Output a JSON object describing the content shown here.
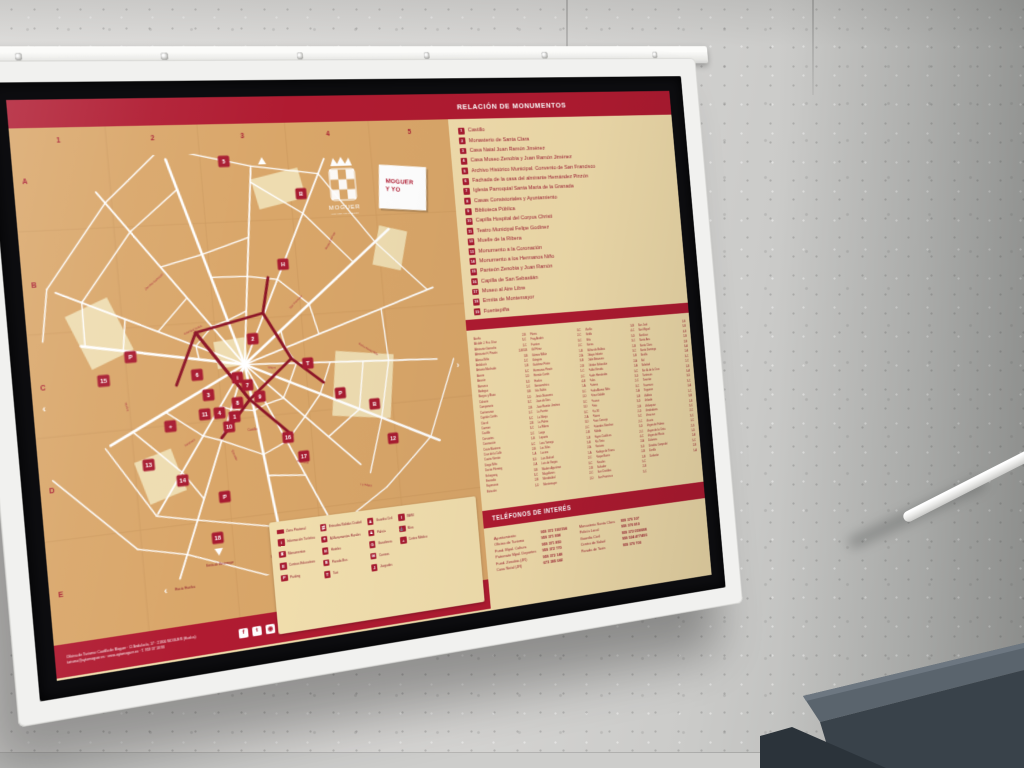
{
  "board": {
    "header": {
      "monuments_title": "RELACIÓN DE MONUMENTOS"
    },
    "logo": {
      "city": "MOGUER",
      "tagline": "LUGARES COLOMBINOS"
    },
    "brand_card": {
      "line1": "MOGUER",
      "line2": "Y YO"
    },
    "colors": {
      "band_red": "#b01b31",
      "marker_red": "#a81c31",
      "map_tan": "#d9a669",
      "panel_cream": "#f0dcab",
      "street_white": "#ffffff",
      "pedestrian_red": "#8c1527"
    },
    "map": {
      "grid_cols": [
        "1",
        "2",
        "3",
        "4",
        "5"
      ],
      "grid_rows": [
        "A",
        "B",
        "C",
        "D",
        "E"
      ],
      "exit_left": "Hacia Huelva",
      "exit_right": "Hacia Mazagón",
      "down_label_1": "Ermita de Montemayor",
      "down_label_2": "Fuentepiña",
      "markers": [
        {
          "t": "5",
          "x": 193,
          "y": 36
        },
        {
          "t": "2",
          "x": 206,
          "y": 208
        },
        {
          "t": "15",
          "x": 64,
          "y": 236
        },
        {
          "t": "6",
          "x": 150,
          "y": 238
        },
        {
          "t": "7",
          "x": 197,
          "y": 252
        },
        {
          "t": "3",
          "x": 159,
          "y": 258
        },
        {
          "t": "8",
          "x": 186,
          "y": 268
        },
        {
          "t": "9",
          "x": 208,
          "y": 264
        },
        {
          "t": "1",
          "x": 182,
          "y": 281
        },
        {
          "t": "4",
          "x": 168,
          "y": 276
        },
        {
          "t": "11",
          "x": 154,
          "y": 276
        },
        {
          "t": "10",
          "x": 176,
          "y": 290
        },
        {
          "t": "13",
          "x": 98,
          "y": 318
        },
        {
          "t": "14",
          "x": 128,
          "y": 336
        },
        {
          "t": "16",
          "x": 232,
          "y": 306
        },
        {
          "t": "17",
          "x": 246,
          "y": 326
        },
        {
          "t": "12",
          "x": 338,
          "y": 318
        },
        {
          "t": "18",
          "x": 156,
          "y": 394
        },
        {
          "t": "19",
          "x": 212,
          "y": 394
        },
        {
          "t": "P",
          "x": 90,
          "y": 216
        },
        {
          "t": "P",
          "x": 166,
          "y": 356
        },
        {
          "t": "P",
          "x": 288,
          "y": 268
        },
        {
          "t": "H",
          "x": 242,
          "y": 138
        },
        {
          "t": "B",
          "x": 322,
          "y": 282
        },
        {
          "t": "B",
          "x": 266,
          "y": 70
        },
        {
          "t": "i",
          "x": 188,
          "y": 244
        },
        {
          "t": "+",
          "x": 121,
          "y": 284
        },
        {
          "t": "T",
          "x": 258,
          "y": 236
        }
      ],
      "street_labels": [
        {
          "t": "Cristóbal Colón",
          "x": 150,
          "y": 196,
          "r": -20
        },
        {
          "t": "Zenobia Camprubí",
          "x": 118,
          "y": 148,
          "r": -38
        },
        {
          "t": "San Francisco",
          "x": 252,
          "y": 176,
          "r": -42
        },
        {
          "t": "Nueva",
          "x": 222,
          "y": 238,
          "r": 8
        },
        {
          "t": "Trasmuro",
          "x": 138,
          "y": 302,
          "r": -28
        },
        {
          "t": "Enmedio",
          "x": 178,
          "y": 318,
          "r": 70
        },
        {
          "t": "Andalucía",
          "x": 244,
          "y": 332,
          "r": 18
        },
        {
          "t": "La Ribera",
          "x": 306,
          "y": 362,
          "r": 14
        },
        {
          "t": "Reyes Católicos",
          "x": 292,
          "y": 118,
          "r": -58
        },
        {
          "t": "Huelva",
          "x": 82,
          "y": 262,
          "r": 78
        },
        {
          "t": "Pedro Alonso Niño",
          "x": 320,
          "y": 228,
          "r": 34
        },
        {
          "t": "Castillo",
          "x": 198,
          "y": 296,
          "r": 0
        }
      ]
    },
    "monuments": [
      {
        "num": "1",
        "name": "Castillo"
      },
      {
        "num": "2",
        "name": "Monasterio de Santa Clara"
      },
      {
        "num": "3",
        "name": "Casa Natal Juan Ramón Jiménez"
      },
      {
        "num": "4",
        "name": "Casa Museo Zenobia y Juan Ramón Jiménez"
      },
      {
        "num": "5",
        "name": "Archivo Histórico Municipal. Convento de San Francisco"
      },
      {
        "num": "6",
        "name": "Fachada de la casa del almirante Hernández Pinzón"
      },
      {
        "num": "7",
        "name": "Iglesia Parroquial Santa María de la Granada"
      },
      {
        "num": "8",
        "name": "Casas Consistoriales y Ayuntamiento"
      },
      {
        "num": "9",
        "name": "Biblioteca Pública"
      },
      {
        "num": "10",
        "name": "Capilla Hospital del Corpus Christi"
      },
      {
        "num": "11",
        "name": "Teatro Municipal Felipe Godínez"
      },
      {
        "num": "12",
        "name": "Muelle de la Ribera"
      },
      {
        "num": "13",
        "name": "Monumento a la Coronación"
      },
      {
        "num": "14",
        "name": "Monumento a los Hermanos Niño"
      },
      {
        "num": "15",
        "name": "Panteón Zenobia y Juan Ramón"
      },
      {
        "num": "16",
        "name": "Capilla de San Sebastián"
      },
      {
        "num": "17",
        "name": "Museo al Aire Libre"
      },
      {
        "num": "18",
        "name": "Ermita de Montemayor"
      },
      {
        "num": "19",
        "name": "Fuentepiña"
      }
    ],
    "street_index": {
      "columns": [
        [
          {
            "n": "Aceña",
            "r": "2-B"
          },
          {
            "n": "Alcalde J. Fco. Díaz",
            "r": "3-C"
          },
          {
            "n": "Almirante Garrocho",
            "r": "2-C"
          },
          {
            "n": "Almirante H. Pinzón",
            "r": "2-B/3-B"
          },
          {
            "n": "Alonso Niño",
            "r": "3-B"
          },
          {
            "n": "Andalucía",
            "r": "2-C"
          },
          {
            "n": "Antonio Machado",
            "r": "1-B"
          },
          {
            "n": "Aurora",
            "r": "3-C"
          },
          {
            "n": "Azacán",
            "r": "2-D"
          },
          {
            "n": "Barranco",
            "r": "3-D"
          },
          {
            "n": "Bodegas",
            "r": "2-C"
          },
          {
            "n": "Burgos y Mazo",
            "r": "3-B"
          },
          {
            "n": "Calvario",
            "r": "2-D"
          },
          {
            "n": "Campanario",
            "r": "3-C"
          },
          {
            "n": "Cantarranas",
            "r": "2-B"
          },
          {
            "n": "Capitán Cortés",
            "r": "1-C"
          },
          {
            "n": "Cárcel",
            "r": "3-C"
          },
          {
            "n": "Carmen",
            "r": "2-B"
          },
          {
            "n": "Castillo",
            "r": "3-C"
          },
          {
            "n": "Cervantes",
            "r": "2-C"
          },
          {
            "n": "Coronación",
            "r": "1-B"
          },
          {
            "n": "Cristo Marinero",
            "r": "4-C"
          },
          {
            "n": "Cruz de la Calle",
            "r": "2-B"
          },
          {
            "n": "Cuatro Vientos",
            "r": "1-A"
          },
          {
            "n": "Diego Niño",
            "r": "3-D"
          },
          {
            "n": "Doctor Fleming",
            "r": "2-A"
          },
          {
            "n": "Echegaray",
            "r": "3-B"
          },
          {
            "n": "Enmedio",
            "r": "3-C"
          },
          {
            "n": "Esperanza",
            "r": "2-B"
          },
          {
            "n": "Estación",
            "r": "1-D"
          }
        ],
        [
          {
            "n": "Flores",
            "r": "3-C"
          },
          {
            "n": "Fray Andrés",
            "r": "2-C"
          },
          {
            "n": "Fuentes",
            "r": "3-C"
          },
          {
            "n": "Gil Pérez",
            "r": "2-C"
          },
          {
            "n": "Gómez Millán",
            "r": "1-B"
          },
          {
            "n": "Góngora",
            "r": "2-A"
          },
          {
            "n": "Gutiérrez Prieto",
            "r": "3-B"
          },
          {
            "n": "Hermanos Pinzón",
            "r": "2-B"
          },
          {
            "n": "Hernán Cortés",
            "r": "1-C"
          },
          {
            "n": "Huelva",
            "r": "2-C"
          },
          {
            "n": "Iberoamérica",
            "r": "4-B"
          },
          {
            "n": "Isla Saltés",
            "r": "1-A"
          },
          {
            "n": "Jesús Nazareno",
            "r": "3-C"
          },
          {
            "n": "Juan de Dios",
            "r": "2-D"
          },
          {
            "n": "Juan Ramón Jiménez",
            "r": "3-C"
          },
          {
            "n": "La Fuente",
            "r": "3-D"
          },
          {
            "n": "La Monja",
            "r": "3-C"
          },
          {
            "n": "La Palma",
            "r": "2-A"
          },
          {
            "n": "La Ribera",
            "r": "3-D"
          },
          {
            "n": "Larga",
            "r": "2-C"
          },
          {
            "n": "Lepanto",
            "r": "2-B"
          },
          {
            "n": "Lora Tamayo",
            "r": "1-B"
          },
          {
            "n": "Los Silos",
            "r": "3-B"
          },
          {
            "n": "Lucena",
            "r": "2-A"
          },
          {
            "n": "Luis Buñuel",
            "r": "1-A"
          },
          {
            "n": "Luis de Vargas",
            "r": "2-C"
          },
          {
            "n": "Madres Agustinas",
            "r": "3-C"
          },
          {
            "n": "Magallanes",
            "r": "2-B"
          },
          {
            "n": "Mendizábal",
            "r": "2-C"
          },
          {
            "n": "Montemayor",
            "r": "2-D"
          }
        ],
        [
          {
            "n": "Murillo",
            "r": "3-B"
          },
          {
            "n": "Niebla",
            "r": "4-C"
          },
          {
            "n": "Niña",
            "r": "3-D"
          },
          {
            "n": "Nueva",
            "r": "3-C"
          },
          {
            "n": "Núñez de Balboa",
            "r": "2-B"
          },
          {
            "n": "Obispo Infante",
            "r": "3-C"
          },
          {
            "n": "Odón Betanzos",
            "r": "1-B"
          },
          {
            "n": "Orfebre Sebastián",
            "r": "2-A"
          },
          {
            "n": "Pablo Neruda",
            "r": "1-A"
          },
          {
            "n": "Padre Hernández",
            "r": "3-C"
          },
          {
            "n": "Palos",
            "r": "3-D"
          },
          {
            "n": "Paterna",
            "r": "2-C"
          },
          {
            "n": "Pedro Alonso Niño",
            "r": "3-C"
          },
          {
            "n": "Pérez Galdós",
            "r": "2-A"
          },
          {
            "n": "Picasso",
            "r": "1-B"
          },
          {
            "n": "Pinta",
            "r": "3-D"
          },
          {
            "n": "Pío XII",
            "r": "2-B"
          },
          {
            "n": "Platero",
            "r": "2-D"
          },
          {
            "n": "Pozo Concejo",
            "r": "3-C"
          },
          {
            "n": "Práxedes Sánchez",
            "r": "2-C"
          },
          {
            "n": "Rábida",
            "r": "3-D"
          },
          {
            "n": "Reyes Católicos",
            "r": "2-C"
          },
          {
            "n": "Río Tinto",
            "r": "4-C"
          },
          {
            "n": "Rociana",
            "r": "2-A"
          },
          {
            "n": "Rodrigo de Triana",
            "r": "3-D"
          },
          {
            "n": "Roque Barcia",
            "r": "2-B"
          },
          {
            "n": "Rosales",
            "r": "1-B"
          },
          {
            "n": "Salvador",
            "r": "3-C"
          },
          {
            "n": "San Cristóbal",
            "r": "2-B"
          },
          {
            "n": "San Francisco",
            "r": "3-C"
          }
        ],
        [
          {
            "n": "San José",
            "r": "2-B"
          },
          {
            "n": "San Miguel",
            "r": "3-B"
          },
          {
            "n": "Sanlúcar",
            "r": "4-B"
          },
          {
            "n": "Santa Ana",
            "r": "2-B"
          },
          {
            "n": "Santa Clara",
            "r": "2-B"
          },
          {
            "n": "Santo Domingo",
            "r": "3-A"
          },
          {
            "n": "Sevilla",
            "r": "2-A"
          },
          {
            "n": "Sol",
            "r": "3-C"
          },
          {
            "n": "Soledad",
            "r": "2-C"
          },
          {
            "n": "Sor Á. de la Cruz",
            "r": "2-B"
          },
          {
            "n": "Tartessos",
            "r": "4-A"
          },
          {
            "n": "Tenerías",
            "r": "3-D"
          },
          {
            "n": "Trasmuro",
            "r": "3-C"
          },
          {
            "n": "Trigueros",
            "r": "2-A"
          },
          {
            "n": "Valdivia",
            "r": "1-C"
          },
          {
            "n": "Velarde",
            "r": "3-B"
          },
          {
            "n": "Velázquez",
            "r": "1-B"
          },
          {
            "n": "Vendedores",
            "r": "3-C"
          },
          {
            "n": "Veracruz",
            "r": "2-C"
          },
          {
            "n": "Vicario",
            "r": "3-C"
          },
          {
            "n": "Virgen de Fátima",
            "r": "1-C"
          },
          {
            "n": "Virgen de la Cinta",
            "r": "2-D"
          },
          {
            "n": "Virgen del Rocío",
            "r": "1-D"
          },
          {
            "n": "Zalamea",
            "r": "2-A"
          },
          {
            "n": "Zenobia Camprubí",
            "r": "3-C"
          },
          {
            "n": "Zorrilla",
            "r": "2-B"
          },
          {
            "n": "Zurbarán",
            "r": "1-A"
          }
        ]
      ]
    },
    "legend": {
      "columns": [
        [
          {
            "icon": "pedestrian-zone-swatch",
            "glyph": "",
            "label": "Zona Peatonal"
          },
          {
            "icon": "tourist-info-icon",
            "glyph": "i",
            "label": "Información Turística"
          },
          {
            "icon": "monument-icon",
            "glyph": "♜",
            "label": "Monumentos"
          },
          {
            "icon": "education-icon",
            "glyph": "E",
            "label": "Centros Educativos"
          },
          {
            "icon": "parking-icon",
            "glyph": "P",
            "label": "Parking"
          }
        ],
        [
          {
            "icon": "city-exits-icon",
            "glyph": "⇄",
            "label": "Entradas/Salidas Ciudad"
          },
          {
            "icon": "rural-monuments-icon",
            "glyph": "✦",
            "label": "A Monumentos Rurales"
          },
          {
            "icon": "hotel-icon",
            "glyph": "H",
            "label": "Hoteles"
          },
          {
            "icon": "bus-stop-icon",
            "glyph": "B",
            "label": "Parada Bus"
          },
          {
            "icon": "taxi-icon",
            "glyph": "T",
            "label": "Taxi"
          }
        ],
        [
          {
            "icon": "guardia-civil-icon",
            "glyph": "♟",
            "label": "Guardia Civil"
          },
          {
            "icon": "police-icon",
            "glyph": "♟",
            "label": "Policía"
          },
          {
            "icon": "gas-station-icon",
            "glyph": "G",
            "label": "Gasolinera"
          },
          {
            "icon": "post-office-icon",
            "glyph": "✉",
            "label": "Correos"
          },
          {
            "icon": "courthouse-icon",
            "glyph": "J",
            "label": "Juzgados"
          }
        ],
        [
          {
            "icon": "inem-icon",
            "glyph": "I",
            "label": "INEM"
          },
          {
            "icon": "river-icon",
            "glyph": "⚓",
            "label": "Ríos"
          },
          {
            "icon": "medical-center-icon",
            "glyph": "+",
            "label": "Centro Médico"
          }
        ]
      ]
    },
    "phones": {
      "title": "TELÉFONOS DE INTERÉS",
      "groups": [
        {
          "labels": [
            "Ayuntamiento",
            "Oficina de Turismo",
            "Fund. Mpal. Cultura",
            "Patronato Mpal. Deportes",
            "Fund. Zenobia (JR)",
            "Casa Natal (JR)"
          ],
          "numbers": [
            "959 372 193/194",
            "959 371 898",
            "959 371 850",
            "959 372 770",
            "959 372 148",
            "673 385 042"
          ]
        },
        {
          "labels": [
            "Monasterio Santa Clara",
            "Policía Local",
            "Guardia Civil",
            "Centro de Salud",
            "Parada de Taxis"
          ],
          "numbers": [
            "959 370 107",
            "959 370 810",
            "959 372 059/088",
            "959 524 477/493",
            "959 370 700"
          ]
        }
      ]
    },
    "footer": {
      "line1": "Oficina de Turismo: Castillo de Moguer · C/ Andalucía, 17 · 21800 MOGUER (Huelva)",
      "line2": "turismo@aytomoguer.es · www.aytomoguer.es · T. 959 37 18 98",
      "social": [
        {
          "icon": "facebook-icon",
          "glyph": "f"
        },
        {
          "icon": "twitter-icon",
          "glyph": "t"
        },
        {
          "icon": "instagram-icon",
          "glyph": "◉"
        }
      ]
    }
  }
}
